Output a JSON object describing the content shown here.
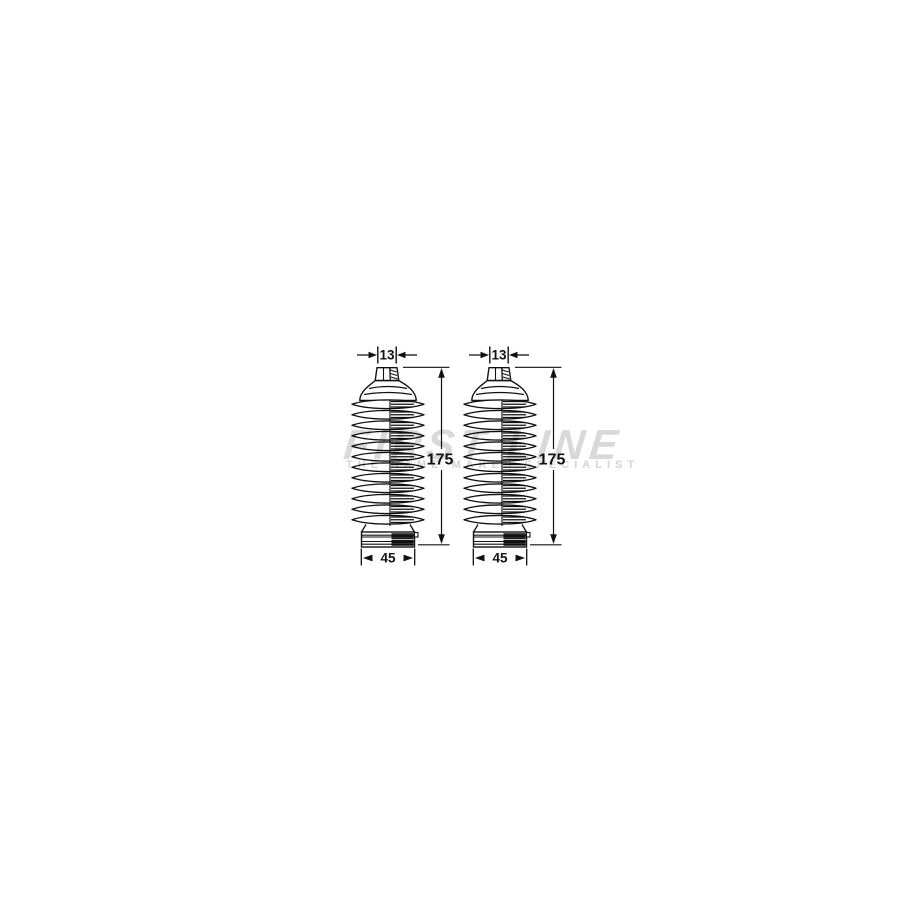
{
  "page": {
    "background_color": "#ffffff",
    "line_color": "#111111"
  },
  "watermark": {
    "brand": "FIRST LINE",
    "tagline": "THE NAME MAKES SPECIALIST",
    "color": "#d9d9d9"
  },
  "diagram": {
    "description": "Technical line drawing of a steering rack boot (bellows gaiter) kit: two identical corrugated boots shown side by side with dimension annotations",
    "boots": [
      {
        "position": "left",
        "top_width": "13",
        "height": "175",
        "base_width": "45"
      },
      {
        "position": "right",
        "top_width": "13",
        "height": "175",
        "base_width": "45"
      }
    ]
  }
}
